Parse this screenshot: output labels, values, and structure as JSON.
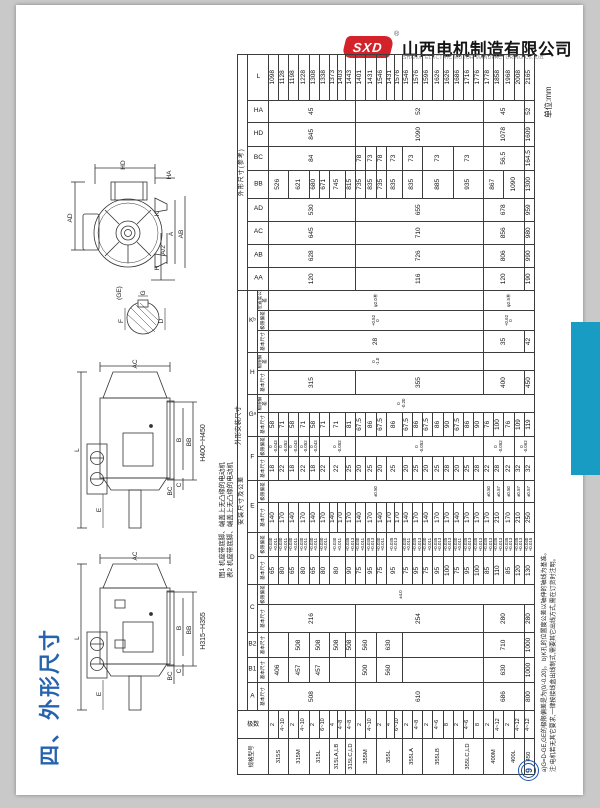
{
  "header": {
    "logo_text": "SXD",
    "reg_mark": "®",
    "company_cn": "山西电机制造有限公司",
    "company_en": "SHANXI ELECTRIC MOTOR MANUFACTURING Co.,Ltd."
  },
  "unit_label": "单位:mm",
  "section_title": "四、外形尺寸",
  "page_number": "9",
  "caption": {
    "line1": "图1 机座带底脚、端盖上无凸缘的电动机",
    "line2": "表2 机座带底脚、端盖上无凸缘的电动机",
    "line3": "外形安装尺寸"
  },
  "notes": {
    "line1": "a)G=D-GE,GE的极限偏差是为(0/-0.20)。 b)K孔的位置度公差以轴伸的轴线为基准。",
    "line2": "注:电机若无其它要求,一律按接线盒出线制式,需要其它出线方式,需在订货时注明。"
  },
  "colors": {
    "accent_blue": "#189cc3",
    "title_blue": "#2563ae",
    "logo_red": "#d3222a"
  },
  "drawings": {
    "end_view": {
      "hd": "HD",
      "ha": "HA",
      "ad": "AD",
      "k": "K",
      "ab": "AB",
      "a": "A",
      "a2": "A/2",
      "h": "H",
      "ge": "(GE)",
      "g": "G",
      "f": "F",
      "d": "D"
    },
    "side_view_large": {
      "ac": "AC",
      "l": "L",
      "e": "E",
      "bc": "BC",
      "c": "C",
      "b": "B",
      "bb": "BB",
      "range": "H400~H450"
    },
    "side_view_small": {
      "ac": "AC",
      "l": "L",
      "e": "E",
      "bc": "BC",
      "c": "C",
      "b": "B",
      "bb": "BB",
      "range": "H315~H355"
    }
  },
  "table": {
    "corner": {
      "model": "规格型号",
      "poles": "极数"
    },
    "groups": [
      {
        "label": "安装尺寸及公差",
        "span": 18
      },
      {
        "label": "外形尺寸(参考)",
        "span": 9
      }
    ],
    "columns": [
      {
        "letter": "A",
        "subs": [
          "基本尺寸"
        ],
        "keys": [
          "A"
        ]
      },
      {
        "letter": "B1",
        "subs": [
          "基本尺寸"
        ],
        "keys": [
          "B1"
        ]
      },
      {
        "letter": "B2",
        "subs": [
          "基本尺寸"
        ],
        "keys": [
          "B2"
        ]
      },
      {
        "letter": "C",
        "subs": [
          "基本尺寸",
          "极限偏差"
        ],
        "keys": [
          "Cb",
          "Cd"
        ]
      },
      {
        "letter": "D",
        "subs": [
          "基本尺寸",
          "极限偏差"
        ],
        "keys": [
          "Db",
          "Dd"
        ]
      },
      {
        "letter": "E",
        "subs": [
          "基本尺寸",
          "极限偏差"
        ],
        "keys": [
          "Eb",
          "Ed"
        ]
      },
      {
        "letter": "F",
        "subs": [
          "基本尺寸",
          "极限偏差"
        ],
        "keys": [
          "Fb",
          "Fd"
        ]
      },
      {
        "letter": "Gᵃ",
        "subs": [
          "基本尺寸",
          "极限偏差"
        ],
        "keys": [
          "Gb",
          "Gd"
        ]
      },
      {
        "letter": "H",
        "subs": [
          "基本尺寸",
          "极限偏差"
        ],
        "keys": [
          "Hb",
          "Hd"
        ]
      },
      {
        "letter": "Kᵇ",
        "subs": [
          "基本尺寸",
          "极限偏差",
          "位置度公差"
        ],
        "keys": [
          "Kb",
          "Kd",
          "Kp"
        ]
      },
      {
        "letter": "AA",
        "keys": [
          "AA"
        ]
      },
      {
        "letter": "AB",
        "keys": [
          "AB"
        ]
      },
      {
        "letter": "AC",
        "keys": [
          "AC"
        ]
      },
      {
        "letter": "AD",
        "keys": [
          "AD"
        ]
      },
      {
        "letter": "BB",
        "keys": [
          "BB"
        ]
      },
      {
        "letter": "BC",
        "keys": [
          "BC"
        ]
      },
      {
        "letter": "HD",
        "keys": [
          "HD"
        ]
      },
      {
        "letter": "HA",
        "keys": [
          "HA"
        ]
      },
      {
        "letter": "L",
        "keys": [
          "L"
        ]
      }
    ],
    "col_widths": [
      36,
      28,
      28,
      25,
      25,
      28,
      20,
      28,
      24,
      30,
      22,
      24,
      20,
      24,
      18,
      24,
      18,
      22,
      20,
      20,
      23,
      23,
      23,
      23,
      28,
      24,
      24,
      22,
      46
    ],
    "models": [
      {
        "name": "315S",
        "poles": [
          "2",
          "4~10"
        ]
      },
      {
        "name": "315M",
        "poles": [
          "2",
          "4~10"
        ]
      },
      {
        "name": "315L",
        "poles": [
          "2",
          "6~10"
        ]
      },
      {
        "name": "315LA,LB",
        "poles": [
          "4",
          "4~8"
        ]
      },
      {
        "name": "315LC,LD",
        "poles": [
          "4~8"
        ]
      },
      {
        "name": "355M",
        "poles": [
          "2",
          "4~10"
        ]
      },
      {
        "name": "355L",
        "poles": [
          "2",
          "4",
          "6~10"
        ]
      },
      {
        "name": "355LA",
        "poles": [
          "2",
          "4~8"
        ]
      },
      {
        "name": "355LB",
        "poles": [
          "2",
          "4~6",
          "8"
        ]
      },
      {
        "name": "355LC,LD",
        "poles": [
          "2",
          "4~6",
          "8"
        ]
      },
      {
        "name": "400M",
        "poles": [
          "2",
          "4~12"
        ]
      },
      {
        "name": "400L",
        "poles": [
          "2",
          "4~12"
        ]
      },
      {
        "name": "450",
        "poles": [
          "4~12"
        ]
      }
    ],
    "cells": {
      "A": [
        [
          "508",
          9
        ],
        [
          "610",
          13
        ],
        [
          "686",
          4
        ],
        [
          "800",
          1
        ]
      ],
      "B1": [
        [
          "406",
          2
        ],
        [
          "457",
          2
        ],
        [
          "457",
          2
        ],
        [
          "",
          3
        ],
        [
          "500",
          2
        ],
        [
          "560",
          3
        ],
        [
          "",
          8
        ],
        [
          "630",
          4
        ],
        [
          "1000",
          1
        ]
      ],
      "B2": [
        [
          "",
          2
        ],
        [
          "508",
          2
        ],
        [
          "508",
          2
        ],
        [
          "508",
          2
        ],
        [
          "508",
          1
        ],
        [
          "560",
          2
        ],
        [
          "630",
          3
        ],
        [
          "",
          8
        ],
        [
          "710",
          4
        ],
        [
          "1000",
          1
        ]
      ],
      "Cb": [
        [
          "216",
          9
        ],
        [
          "254",
          13
        ],
        [
          "280",
          4
        ],
        [
          "280",
          1
        ]
      ],
      "Cd": [
        [
          "±4.0",
          27
        ]
      ],
      "Db": [
        [
          "65",
          1
        ],
        [
          "80",
          1
        ],
        [
          "65",
          1
        ],
        [
          "80",
          1
        ],
        [
          "65",
          1
        ],
        [
          "80",
          1
        ],
        [
          "80",
          2
        ],
        [
          "90",
          1
        ],
        [
          "75",
          1
        ],
        [
          "95",
          1
        ],
        [
          "75",
          1
        ],
        [
          "95",
          2
        ],
        [
          "75",
          1
        ],
        [
          "95",
          1
        ],
        [
          "75",
          1
        ],
        [
          "95",
          1
        ],
        [
          "100",
          1
        ],
        [
          "75",
          1
        ],
        [
          "95",
          1
        ],
        [
          "100",
          1
        ],
        [
          "85",
          1
        ],
        [
          "110",
          1
        ],
        [
          "85",
          1
        ],
        [
          "120",
          1
        ],
        [
          "130",
          1
        ]
      ],
      "Dd": [
        [
          "+0.030\n+0.011",
          1
        ],
        [
          "+0.030\n+0.011",
          1
        ],
        [
          "+0.030\n+0.011",
          1
        ],
        [
          "+0.030\n+0.011",
          1
        ],
        [
          "+0.030\n+0.011",
          1
        ],
        [
          "+0.030\n+0.011",
          1
        ],
        [
          "+0.030\n+0.011",
          2
        ],
        [
          "+0.035\n+0.013",
          1
        ],
        [
          "+0.030\n+0.011",
          1
        ],
        [
          "+0.035\n+0.013",
          1
        ],
        [
          "+0.030\n+0.011",
          1
        ],
        [
          "+0.035\n+0.013",
          2
        ],
        [
          "+0.030\n+0.011",
          1
        ],
        [
          "+0.035\n+0.013",
          1
        ],
        [
          "+0.030\n+0.011",
          1
        ],
        [
          "+0.035\n+0.013",
          1
        ],
        [
          "+0.035\n+0.013",
          1
        ],
        [
          "+0.030\n+0.011",
          1
        ],
        [
          "+0.035\n+0.013",
          1
        ],
        [
          "+0.035\n+0.013",
          1
        ],
        [
          "+0.035\n+0.013",
          1
        ],
        [
          "+0.035\n+0.013",
          1
        ],
        [
          "+0.035\n+0.013",
          1
        ],
        [
          "+0.035\n+0.013",
          1
        ],
        [
          "+0.040\n+0.015",
          1
        ]
      ],
      "Eb": [
        [
          "140",
          1
        ],
        [
          "170",
          1
        ],
        [
          "140",
          1
        ],
        [
          "170",
          1
        ],
        [
          "140",
          1
        ],
        [
          "170",
          1
        ],
        [
          "140",
          1
        ],
        [
          "170",
          1
        ],
        [
          "170",
          1
        ],
        [
          "140",
          1
        ],
        [
          "170",
          1
        ],
        [
          "140",
          1
        ],
        [
          "170",
          1
        ],
        [
          "170",
          1
        ],
        [
          "140",
          1
        ],
        [
          "170",
          1
        ],
        [
          "140",
          1
        ],
        [
          "170",
          1
        ],
        [
          "170",
          1
        ],
        [
          "140",
          1
        ],
        [
          "170",
          1
        ],
        [
          "170",
          1
        ],
        [
          "170",
          1
        ],
        [
          "210",
          1
        ],
        [
          "170",
          1
        ],
        [
          "210",
          1
        ],
        [
          "250",
          1
        ]
      ],
      "Ed": [
        [
          "±0.50",
          22
        ],
        [
          "±0.50",
          1
        ],
        [
          "±0.57",
          1
        ],
        [
          "±0.50",
          1
        ],
        [
          "±0.57",
          1
        ],
        [
          "±0.57",
          1
        ]
      ],
      "Fb": [
        [
          "18",
          1
        ],
        [
          "22",
          1
        ],
        [
          "18",
          1
        ],
        [
          "22",
          1
        ],
        [
          "18",
          1
        ],
        [
          "22",
          1
        ],
        [
          "22",
          2
        ],
        [
          "25",
          1
        ],
        [
          "20",
          1
        ],
        [
          "25",
          1
        ],
        [
          "20",
          1
        ],
        [
          "25",
          2
        ],
        [
          "20",
          1
        ],
        [
          "25",
          1
        ],
        [
          "20",
          1
        ],
        [
          "25",
          1
        ],
        [
          "28",
          1
        ],
        [
          "20",
          1
        ],
        [
          "25",
          1
        ],
        [
          "28",
          1
        ],
        [
          "22",
          1
        ],
        [
          "28",
          1
        ],
        [
          "22",
          1
        ],
        [
          "32",
          1
        ],
        [
          "32",
          1
        ]
      ],
      "Fd": [
        [
          "0\n-0.043",
          1
        ],
        [
          "0\n-0.052",
          1
        ],
        [
          "0\n-0.043",
          1
        ],
        [
          "0\n-0.052",
          1
        ],
        [
          "0\n-0.043",
          1
        ],
        [
          "0\n-0.052",
          4
        ],
        [
          "0\n-0.052",
          13
        ],
        [
          "0\n-0.052",
          3
        ],
        [
          "0\n-0.062",
          2
        ]
      ],
      "Gb": [
        [
          "58",
          1
        ],
        [
          "71",
          1
        ],
        [
          "58",
          1
        ],
        [
          "71",
          1
        ],
        [
          "58",
          1
        ],
        [
          "71",
          1
        ],
        [
          "71",
          2
        ],
        [
          "81",
          1
        ],
        [
          "67.5",
          1
        ],
        [
          "86",
          1
        ],
        [
          "67.5",
          1
        ],
        [
          "86",
          2
        ],
        [
          "67.5",
          1
        ],
        [
          "86",
          1
        ],
        [
          "67.5",
          1
        ],
        [
          "86",
          1
        ],
        [
          "90",
          1
        ],
        [
          "67.5",
          1
        ],
        [
          "86",
          1
        ],
        [
          "90",
          1
        ],
        [
          "76",
          1
        ],
        [
          "100",
          1
        ],
        [
          "76",
          1
        ],
        [
          "109",
          1
        ],
        [
          "119",
          1
        ]
      ],
      "Gd": [
        [
          "0\n-0.20",
          27
        ]
      ],
      "Hb": [
        [
          "315",
          9
        ],
        [
          "355",
          13
        ],
        [
          "400",
          4
        ],
        [
          "450",
          1
        ]
      ],
      "Hd": [
        [
          "0\n-1.0",
          22
        ],
        [
          "",
          5
        ]
      ],
      "Kb": [
        [
          "28",
          22
        ],
        [
          "35",
          4
        ],
        [
          "42",
          1
        ]
      ],
      "Kd": [
        [
          "+0.52\n0",
          22
        ],
        [
          "+0.62\n0",
          5
        ]
      ],
      "Kp": [
        [
          "φ2.0Ⓜ",
          22
        ],
        [
          "φ2.5Ⓜ",
          5
        ]
      ],
      "AA": [
        [
          "120",
          9
        ],
        [
          "116",
          13
        ],
        [
          "120",
          4
        ],
        [
          "190",
          1
        ]
      ],
      "AB": [
        [
          "628",
          9
        ],
        [
          "726",
          13
        ],
        [
          "806",
          4
        ],
        [
          "990",
          1
        ]
      ],
      "AC": [
        [
          "645",
          9
        ],
        [
          "710",
          13
        ],
        [
          "856",
          4
        ],
        [
          "980",
          1
        ]
      ],
      "AD": [
        [
          "530",
          9
        ],
        [
          "655",
          13
        ],
        [
          "678",
          4
        ],
        [
          "959",
          1
        ]
      ],
      "BB": [
        [
          "526",
          2
        ],
        [
          "621",
          2
        ],
        [
          "680",
          1
        ],
        [
          "671",
          1
        ],
        [
          "745",
          2
        ],
        [
          "815",
          1
        ],
        [
          "735",
          1
        ],
        [
          "835",
          1
        ],
        [
          "735",
          1
        ],
        [
          "835",
          2
        ],
        [
          "835",
          2
        ],
        [
          "885",
          3
        ],
        [
          "935",
          3
        ],
        [
          "867",
          2
        ],
        [
          "1090",
          2
        ],
        [
          "1300",
          1
        ]
      ],
      "BC": [
        [
          "84",
          9
        ],
        [
          "78",
          1
        ],
        [
          "73",
          1
        ],
        [
          "78",
          1
        ],
        [
          "73",
          2
        ],
        [
          "73",
          2
        ],
        [
          "73",
          3
        ],
        [
          "73",
          3
        ],
        [
          "56.5",
          4
        ],
        [
          "164.5",
          1
        ]
      ],
      "HD": [
        [
          "845",
          9
        ],
        [
          "1090",
          13
        ],
        [
          "1078",
          4
        ],
        [
          "1609",
          1
        ]
      ],
      "HA": [
        [
          "45",
          9
        ],
        [
          "52",
          13
        ],
        [
          "45",
          4
        ],
        [
          "52",
          1
        ]
      ],
      "L": [
        [
          "1098",
          1
        ],
        [
          "1128",
          1
        ],
        [
          "1198",
          1
        ],
        [
          "1228",
          1
        ],
        [
          "1308",
          1
        ],
        [
          "1338",
          1
        ],
        [
          "1373",
          1
        ],
        [
          "1403",
          1
        ],
        [
          "1443",
          1
        ],
        [
          "1401",
          1
        ],
        [
          "1431",
          1
        ],
        [
          "1546",
          1
        ],
        [
          "1431",
          1
        ],
        [
          "1576",
          1
        ],
        [
          "1546",
          1
        ],
        [
          "1576",
          1
        ],
        [
          "1596",
          1
        ],
        [
          "1626",
          1
        ],
        [
          "1626",
          1
        ],
        [
          "1686",
          1
        ],
        [
          "1716",
          1
        ],
        [
          "1776",
          1
        ],
        [
          "1778",
          1
        ],
        [
          "1858",
          1
        ],
        [
          "1968",
          1
        ],
        [
          "2008",
          1
        ],
        [
          "2165",
          1
        ]
      ]
    }
  }
}
